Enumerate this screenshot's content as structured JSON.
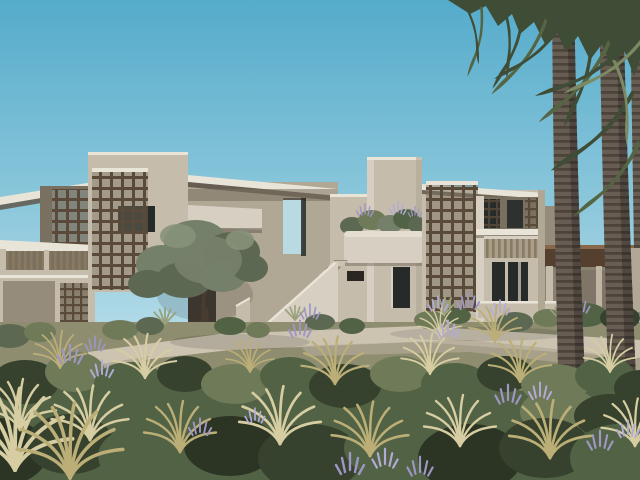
{
  "scene": {
    "type": "3d-architectural-exterior-rendering",
    "description": "Modern two-storey desert residence with wooden lattice screens, cantilevered roof slabs, an exterior staircase, rooftop terrace opening, balcony planter, olive tree, tall fan palms on the right, a distant timber pavilion, and a foreground of shrubs, golden grasses and lavender along a stone pathway under a clear teal-blue sky",
    "elements": [
      "sky",
      "main-building",
      "lattice-screens",
      "canopy-roof-slab",
      "terrace-opening",
      "exterior-stairs",
      "balcony-planter",
      "name-plaque",
      "entry-door",
      "balcony-railing",
      "olive-tree",
      "pathway",
      "palm-trees",
      "distant-pavilion",
      "shrubs",
      "golden-grasses",
      "lavender-flowers"
    ]
  },
  "colors": {
    "sky_top": "#55abcb",
    "sky_mid": "#8fc9dc",
    "sky_pale": "#b7dde9",
    "sky_opening": "#b9d9e3",
    "wall_sunlit": "#d7cfc1",
    "wall_light": "#c6bcab",
    "wall_shaded": "#b1a795",
    "wall_dark": "#968c7b",
    "wall_deep": "#79705f",
    "roof_edge": "#e9e4d8",
    "slab_shadow": "#5f574b",
    "lattice_wood": "#594a39",
    "lattice_sheen": "#87908a",
    "slat_wood": "#8a7a5f",
    "window_glass": "#262b29",
    "plaque": "#2b2621",
    "path_light": "#ccc3b1",
    "path_shade": "#b1a896",
    "pavilion_wood": "#553f2e",
    "pavilion_light": "#87684a",
    "pavilion_shade": "#8a8173",
    "olive_green": "#75806a",
    "olive_dark": "#5d6852",
    "olive_light": "#87917a",
    "olive_trunk": "#473c2f",
    "palm_trunk": "#675d52",
    "palm_band": "#473f37",
    "frond_dark": "#3f4c36",
    "frond_mid": "#556443",
    "frond_light": "#7c8a63",
    "bush_dark": "#36422d",
    "bush_mid": "#526244",
    "bush_sage": "#6f7a58",
    "grass_gold": "#bbae77",
    "grass_pale": "#d6cda2",
    "lavender": "#9e96c4",
    "lavender_light": "#b3abd6",
    "agave": "#98a17c",
    "ground_base": "#8f8d70",
    "ground_dark": "#2c3524"
  }
}
